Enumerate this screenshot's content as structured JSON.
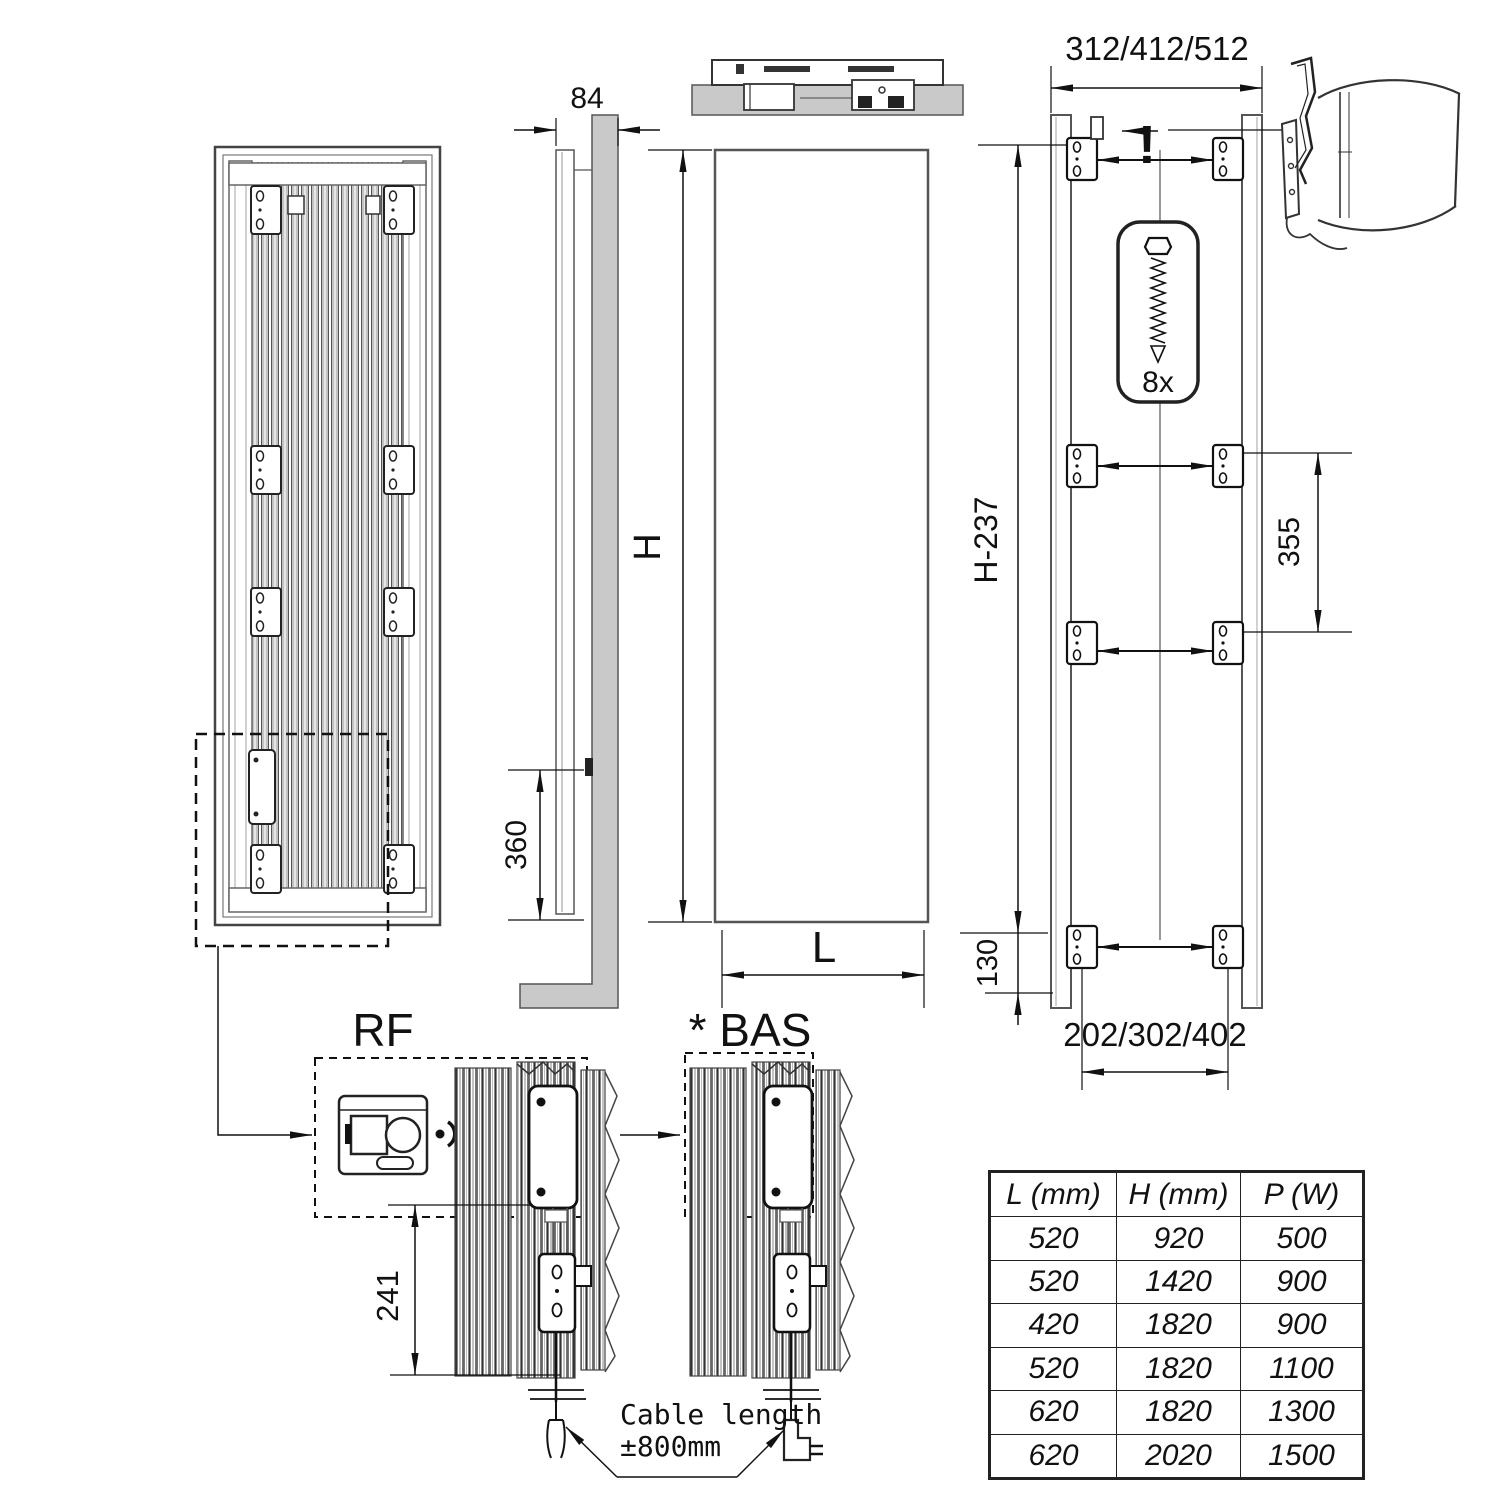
{
  "colors": {
    "line": "#333333",
    "wall_gray": "#c9c9c9"
  },
  "labels": {
    "depth": "84",
    "height": "H",
    "width": "L",
    "lower_mount": "360",
    "top_span": "312/412/512",
    "rear_height": "H-237",
    "bracket_gap": "355",
    "bottom_offset": "130",
    "bottom_span": "202/302/402",
    "screw_count": "8x",
    "warning": "!",
    "rf": "RF",
    "bas": "* BAS",
    "control_height": "241",
    "cable_note_1": "Cable length",
    "cable_note_2": "±800mm"
  },
  "table": {
    "headers": [
      "L (mm)",
      "H (mm)",
      "P (W)"
    ],
    "rows": [
      [
        "520",
        "920",
        "500"
      ],
      [
        "520",
        "1420",
        "900"
      ],
      [
        "420",
        "1820",
        "900"
      ],
      [
        "520",
        "1820",
        "1100"
      ],
      [
        "620",
        "1820",
        "1300"
      ],
      [
        "620",
        "2020",
        "1500"
      ]
    ]
  }
}
